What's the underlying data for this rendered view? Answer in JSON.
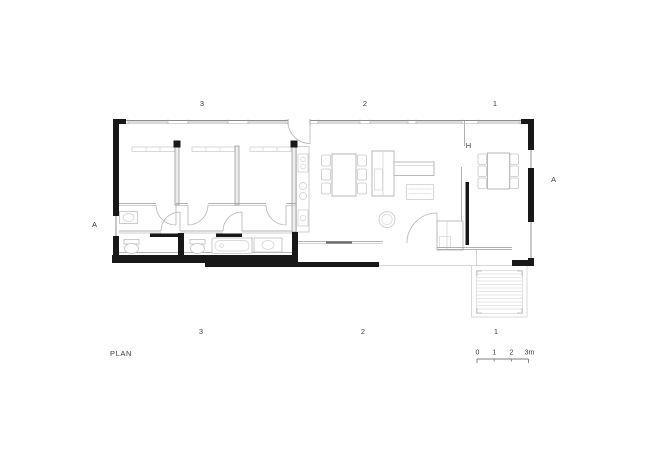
{
  "colors": {
    "wall_black": "#181818",
    "wall_gray": "#9a9a9a",
    "furniture_gray": "#bdbdbd",
    "deck_gray": "#d8d8d8",
    "text": "#3c3c3c"
  },
  "plan": {
    "caption": "PLAN",
    "markers": {
      "top": [
        "3",
        "2",
        "1"
      ],
      "bottom": [
        "3",
        "2",
        "1"
      ],
      "section_left": "A",
      "section_right": "A",
      "interior": "H"
    },
    "scale": {
      "labels": [
        "0",
        "1",
        "2",
        "3m"
      ]
    }
  }
}
